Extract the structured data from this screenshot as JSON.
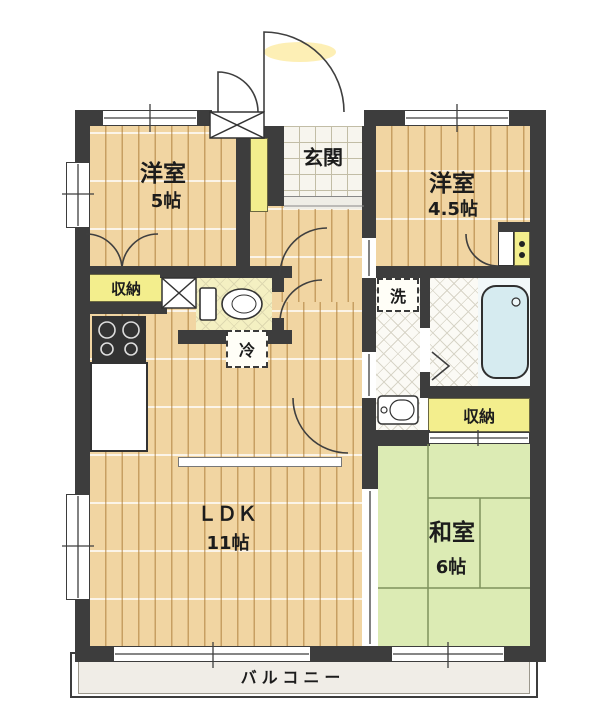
{
  "rooms": {
    "yoshitsu5": {
      "name": "洋室",
      "size": "5帖"
    },
    "yoshitsu45": {
      "name": "洋室",
      "size": "4.5帖"
    },
    "genkan": {
      "name": "玄関"
    },
    "ldk": {
      "name": "ＬＤＫ",
      "size": "11帖"
    },
    "washitsu": {
      "name": "和室",
      "size": "6帖"
    },
    "balcony": {
      "name": "バルコニー"
    }
  },
  "labels": {
    "storage_left": "収納",
    "storage_right": "収納",
    "fridge": "冷",
    "washer": "洗"
  },
  "colors": {
    "wall": "#3d3d3d",
    "wood_floor": "#f1d5a2",
    "tatami": "#dcebb4",
    "closet_yellow": "#f3ee8d",
    "bathtub_blue": "#d6ebf0",
    "entry_tile": "#f7f5ee",
    "balcony": "#f0ede7"
  }
}
